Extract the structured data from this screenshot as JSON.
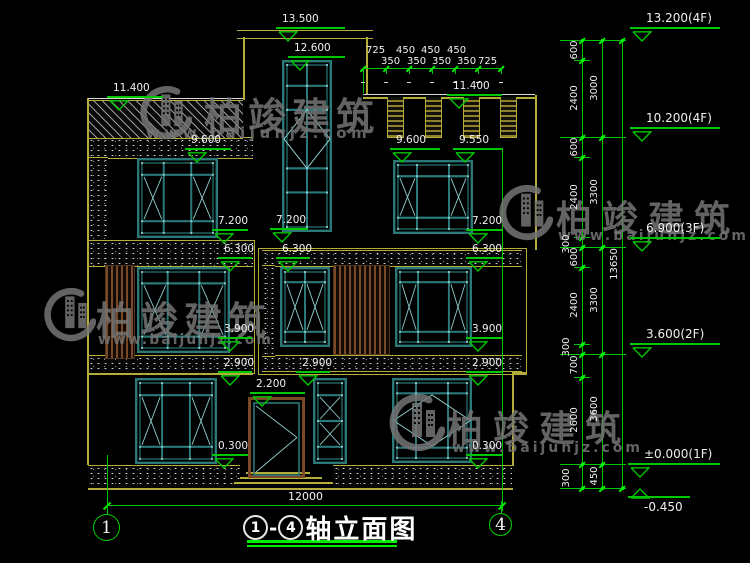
{
  "colors": {
    "green": "#00c800",
    "bright_green": "#00ee00",
    "yellow": "#b5ad3a",
    "frame": "#2a7878",
    "frame_light": "#8ecccc",
    "wood": "#7a4a28",
    "text": "#f0f0f0",
    "watermark": "#757575"
  },
  "watermark": {
    "brand": "柏竣建筑",
    "url": "www.baijunjz.com",
    "instances": [
      {
        "logo": [
          136,
          86,
          56,
          56
        ],
        "brand_pos": [
          204,
          86,
          38,
          6
        ],
        "url_pos": [
          146,
          124,
          15,
          4.5
        ]
      },
      {
        "logo": [
          40,
          286,
          56,
          60
        ],
        "brand_pos": [
          96,
          290,
          38,
          6
        ],
        "url_pos": [
          98,
          332,
          14,
          2
        ]
      },
      {
        "logo": [
          495,
          182,
          58,
          64
        ],
        "brand_pos": [
          556,
          190,
          36,
          10
        ],
        "url_pos": [
          558,
          228,
          14,
          3
        ]
      },
      {
        "logo": [
          385,
          393,
          60,
          62
        ],
        "brand_pos": [
          447,
          400,
          36,
          10
        ],
        "url_pos": [
          452,
          440,
          14,
          3
        ]
      }
    ]
  },
  "title_block": {
    "circle1": "1",
    "dash": "-",
    "circle4": "4",
    "name": "轴立面图"
  },
  "axis_bubbles": [
    {
      "label": "1",
      "x": 107,
      "y": 528,
      "r": 14
    },
    {
      "label": "4",
      "x": 501,
      "y": 525,
      "r": 12
    }
  ],
  "bottom_dim": {
    "label": "12000",
    "line": {
      "x1": 107,
      "x2": 502,
      "y": 505
    },
    "label_pos": [
      288,
      491
    ]
  },
  "top_dim": {
    "line": {
      "x1": 363,
      "x2": 503,
      "y": 68
    },
    "ticks": [
      363,
      386,
      409,
      432,
      455,
      478,
      501
    ],
    "row1": [
      {
        "t": "725",
        "x": 366
      },
      {
        "t": "450",
        "x": 396
      },
      {
        "t": "450",
        "x": 421
      },
      {
        "t": "450",
        "x": 447
      }
    ],
    "row1_y": 46,
    "row2": [
      {
        "t": "350",
        "x": 381
      },
      {
        "t": "350",
        "x": 407
      },
      {
        "t": "350",
        "x": 432
      },
      {
        "t": "350",
        "x": 457
      },
      {
        "t": "725",
        "x": 478
      }
    ],
    "row2_y": 57
  },
  "elevation_markers": [
    {
      "label": "13.500",
      "x": 276,
      "y": 28,
      "w": 69
    },
    {
      "label": "12.600",
      "x": 288,
      "y": 57,
      "w": 57
    },
    {
      "label": "11.400",
      "x": 107,
      "y": 97,
      "w": 56
    },
    {
      "label": "11.400",
      "x": 447,
      "y": 95,
      "w": 55
    },
    {
      "label": "9.600",
      "x": 185,
      "y": 149,
      "w": 46
    },
    {
      "label": "9.600",
      "x": 390,
      "y": 149,
      "w": 50
    },
    {
      "label": "9.550",
      "x": 453,
      "y": 149,
      "w": 49
    },
    {
      "label": "7.200",
      "x": 212,
      "y": 230,
      "w": 36
    },
    {
      "label": "7.200",
      "x": 270,
      "y": 229,
      "w": 38
    },
    {
      "label": "7.200",
      "x": 466,
      "y": 230,
      "w": 36
    },
    {
      "label": "6.300",
      "x": 218,
      "y": 258,
      "w": 34
    },
    {
      "label": "6.300",
      "x": 276,
      "y": 258,
      "w": 34
    },
    {
      "label": "6.300",
      "x": 466,
      "y": 258,
      "w": 36
    },
    {
      "label": "3.900",
      "x": 218,
      "y": 338,
      "w": 34
    },
    {
      "label": "3.900",
      "x": 466,
      "y": 338,
      "w": 36
    },
    {
      "label": "2.900",
      "x": 218,
      "y": 372,
      "w": 34
    },
    {
      "label": "2.900",
      "x": 296,
      "y": 372,
      "w": 34
    },
    {
      "label": "2.900",
      "x": 466,
      "y": 372,
      "w": 36
    },
    {
      "label": "2.200",
      "x": 250,
      "y": 393,
      "w": 55
    },
    {
      "label": "0.300",
      "x": 212,
      "y": 455,
      "w": 36
    },
    {
      "label": "0.300",
      "x": 466,
      "y": 455,
      "w": 36
    },
    {
      "label": "13.200(4F)",
      "x": 630,
      "y": 28,
      "w": 90,
      "big": true
    },
    {
      "label": "10.200(4F)",
      "x": 630,
      "y": 128,
      "w": 90,
      "big": true
    },
    {
      "label": "6.900(3F)",
      "x": 630,
      "y": 238,
      "w": 90,
      "big": true
    },
    {
      "label": "3.600(2F)",
      "x": 630,
      "y": 344,
      "w": 90,
      "big": true
    },
    {
      "label": "±0.000(1F)",
      "x": 628,
      "y": 464,
      "w": 92,
      "big": true
    },
    {
      "label": "-0.450",
      "x": 628,
      "y": 497,
      "w": 62,
      "big": true,
      "flip": true
    }
  ],
  "right_chains": {
    "verticals": [
      582,
      602,
      622
    ],
    "y_top": 40,
    "y_bot": 488,
    "major_breaks": [
      40,
      137,
      247,
      354,
      464,
      488
    ],
    "minor_breaks": [
      60,
      157,
      237,
      267,
      344,
      377
    ],
    "ticks": {
      "582": [
        40,
        60,
        137,
        157,
        237,
        247,
        267,
        344,
        354,
        377,
        464,
        488
      ],
      "602": [
        40,
        137,
        247,
        354,
        464,
        488
      ],
      "622": [
        40,
        488
      ]
    },
    "labels": [
      {
        "t": "600",
        "x": 582,
        "y": 50
      },
      {
        "t": "2400",
        "x": 582,
        "y": 98
      },
      {
        "t": "600",
        "x": 582,
        "y": 147
      },
      {
        "t": "2400",
        "x": 582,
        "y": 197
      },
      {
        "t": "300",
        "x": 574,
        "y": 244
      },
      {
        "t": "600",
        "x": 582,
        "y": 257
      },
      {
        "t": "2400",
        "x": 582,
        "y": 305
      },
      {
        "t": "300",
        "x": 574,
        "y": 347
      },
      {
        "t": "700",
        "x": 582,
        "y": 365
      },
      {
        "t": "2600",
        "x": 582,
        "y": 420
      },
      {
        "t": "300",
        "x": 574,
        "y": 478
      },
      {
        "t": "3000",
        "x": 602,
        "y": 88
      },
      {
        "t": "3300",
        "x": 602,
        "y": 192
      },
      {
        "t": "3300",
        "x": 602,
        "y": 300
      },
      {
        "t": "3600",
        "x": 602,
        "y": 409
      },
      {
        "t": "450",
        "x": 602,
        "y": 476
      },
      {
        "t": "13650",
        "x": 622,
        "y": 264
      }
    ]
  },
  "tower": {
    "slab": [
      237,
      30,
      136,
      7
    ],
    "wall_left": [
      243,
      37,
      100
    ],
    "wall_right": [
      366,
      37,
      95
    ]
  },
  "parapet_hatch": {
    "x": 88,
    "y": 100,
    "w": 155,
    "h": 37
  },
  "merlons": {
    "band_white_y": 94,
    "band_x1": 363,
    "band_x2": 535,
    "items": [
      [
        387,
        97,
        15,
        40
      ],
      [
        425,
        97,
        15,
        40
      ],
      [
        463,
        97,
        15,
        40
      ],
      [
        500,
        97,
        15,
        40
      ]
    ]
  },
  "speckle_bands": [
    {
      "x": 88,
      "y": 137,
      "w": 165,
      "h": 20
    },
    {
      "x": 88,
      "y": 157,
      "w": 20,
      "h": 83
    },
    {
      "x": 88,
      "y": 240,
      "w": 165,
      "h": 25
    },
    {
      "x": 88,
      "y": 355,
      "w": 165,
      "h": 18
    },
    {
      "x": 262,
      "y": 250,
      "w": 260,
      "h": 15
    },
    {
      "x": 262,
      "y": 355,
      "w": 260,
      "h": 15
    },
    {
      "x": 262,
      "y": 265,
      "w": 13,
      "h": 90
    },
    {
      "x": 88,
      "y": 465,
      "w": 152,
      "h": 23
    },
    {
      "x": 333,
      "y": 465,
      "w": 179,
      "h": 23
    }
  ],
  "outline_rects": [
    {
      "x": 88,
      "y": 240,
      "w": 165,
      "h": 132
    },
    {
      "x": 258,
      "y": 248,
      "w": 267,
      "h": 125
    }
  ],
  "wall_lines": [
    {
      "x": 87,
      "y": 98,
      "w": 1.5,
      "h": 367
    },
    {
      "x": 535,
      "y": 95,
      "w": 1.5,
      "h": 155
    },
    {
      "x": 512,
      "y": 373,
      "w": 1.5,
      "h": 93
    },
    {
      "x": 512,
      "y": 372,
      "w": 14,
      "h": 1.5
    },
    {
      "x": 88,
      "y": 488,
      "w": 425,
      "h": 2
    }
  ],
  "white_lines": [
    {
      "x": 88,
      "y": 98,
      "w": 155,
      "h": 1.2
    },
    {
      "x": 363,
      "y": 94,
      "w": 172,
      "h": 1.2
    }
  ],
  "steps": [
    {
      "x": 246,
      "y": 472,
      "w": 64
    },
    {
      "x": 240,
      "y": 477,
      "w": 82
    },
    {
      "x": 234,
      "y": 482,
      "w": 99
    }
  ],
  "green_verticals": [
    {
      "x": 107,
      "y1": 455,
      "y2": 514
    },
    {
      "x": 502,
      "y1": 148,
      "y2": 511
    },
    {
      "x": 363,
      "y1": 68,
      "y2": 93
    }
  ],
  "windows": [
    {
      "name": "tower-window",
      "x": 282,
      "y": 60,
      "w": 50,
      "h": 172,
      "cols": [
        0.5
      ],
      "rows": [
        0.15,
        0.29,
        0.63,
        0.77
      ],
      "diamond": {
        "cx": 0.5,
        "cy": 0.46,
        "rx": 0.46,
        "ry": 0.17
      },
      "dots": true
    },
    {
      "name": "window-4f-left",
      "x": 137,
      "y": 158,
      "w": 81,
      "h": 80,
      "cols": [
        0.33,
        0.67
      ],
      "rows": [
        0.21,
        0.79
      ],
      "xcells": [
        [
          0,
          1
        ],
        [
          2,
          1
        ]
      ],
      "dots": true
    },
    {
      "name": "window-4f-right",
      "x": 393,
      "y": 160,
      "w": 80,
      "h": 74,
      "cols": [
        0.3,
        0.7
      ],
      "rows": [
        0.22,
        0.78
      ],
      "xcells": [
        [
          0,
          1
        ],
        [
          2,
          1
        ]
      ],
      "dots": true
    },
    {
      "name": "window-3f-left",
      "x": 137,
      "y": 267,
      "w": 93,
      "h": 86,
      "cols": [
        0.33,
        0.67
      ],
      "rows": [
        0.19,
        0.81
      ],
      "xcells": [
        [
          0,
          1
        ],
        [
          2,
          1
        ]
      ],
      "dots": true
    },
    {
      "name": "window-3f-center-left",
      "x": 280,
      "y": 267,
      "w": 50,
      "h": 80,
      "cols": [
        0.5
      ],
      "rows": [
        0.19,
        0.81
      ],
      "xcells": [
        [
          0,
          1
        ],
        [
          1,
          1
        ]
      ],
      "dots": true
    },
    {
      "name": "window-3f-center-right",
      "x": 395,
      "y": 267,
      "w": 77,
      "h": 80,
      "cols": [
        0.3,
        0.7
      ],
      "rows": [
        0.19,
        0.81
      ],
      "xcells": [
        [
          0,
          1
        ],
        [
          2,
          1
        ]
      ],
      "dots": true
    },
    {
      "name": "window-1f-left",
      "x": 135,
      "y": 378,
      "w": 82,
      "h": 86,
      "cols": [
        0.33,
        0.67
      ],
      "rows": [
        0.2,
        0.8
      ],
      "xcells": [
        [
          0,
          1
        ],
        [
          2,
          1
        ]
      ],
      "dots": true
    },
    {
      "name": "window-1f-narrow",
      "x": 313,
      "y": 378,
      "w": 34,
      "h": 86,
      "cols": [],
      "rows": [
        0.2,
        0.5,
        0.8
      ],
      "xcells": [
        [
          0,
          1
        ],
        [
          0,
          2
        ]
      ],
      "dots": true
    },
    {
      "name": "window-1f-right",
      "x": 392,
      "y": 378,
      "w": 80,
      "h": 85,
      "cols": [
        0.3,
        0.7
      ],
      "rows": [
        0.18,
        0.82
      ],
      "diamond": {
        "cx": 0.5,
        "cy": 0.5,
        "rx": 0.48,
        "ry": 0.3
      },
      "dots": true
    }
  ],
  "door": {
    "x": 248,
    "y": 397,
    "w": 57,
    "h": 81
  },
  "louvers": [
    {
      "x": 105,
      "y": 265,
      "w": 28,
      "h": 92
    },
    {
      "x": 333,
      "y": 265,
      "w": 55,
      "h": 88
    }
  ]
}
